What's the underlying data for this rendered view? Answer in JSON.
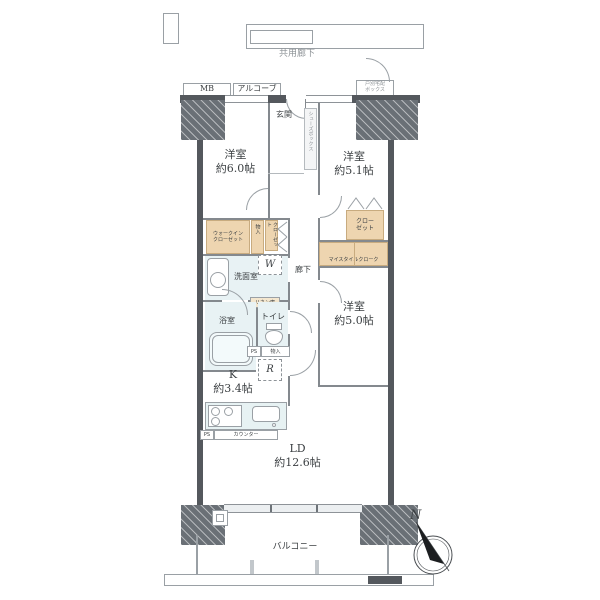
{
  "exterior": {
    "corridor": "共用廊下",
    "mb": "MB",
    "alcove": "アルコーブ",
    "delivery1": "戸別宅配",
    "delivery2": "ボックス",
    "balcony": "バルコニー",
    "compass_n": "N"
  },
  "rooms": {
    "entrance": "玄関",
    "shoe_box": "シューズボックス",
    "bedroom1_name": "洋室",
    "bedroom1_size": "約6.0帖",
    "bedroom2_name": "洋室",
    "bedroom2_size": "約5.1帖",
    "bedroom3_name": "洋室",
    "bedroom3_size": "約5.0帖",
    "kitchen_name": "K",
    "kitchen_size": "約3.4帖",
    "ld_name": "LD",
    "ld_size": "約12.6帖",
    "washroom": "洗面室",
    "bathroom": "浴室",
    "toilet": "トイレ",
    "hallway": "廊下"
  },
  "storage": {
    "wic1": "ウォークイン",
    "wic2": "クローゼット",
    "closet1": "クロー",
    "closet2": "ゼット",
    "closet_tall": "クローゼット",
    "my_style": "マイスタイルクローク",
    "monoire": "物入",
    "monoire2": "物入",
    "linen": "リネン庫"
  },
  "fixtures": {
    "washer": "W",
    "fridge": "R",
    "ps": "PS",
    "ps2": "PS",
    "counter": "カウンター"
  },
  "colors": {
    "wall": "#54585d",
    "closet_fill": "#eed5b0",
    "wet_fill": "#e8f2f4",
    "line": "#9aa0a5"
  }
}
